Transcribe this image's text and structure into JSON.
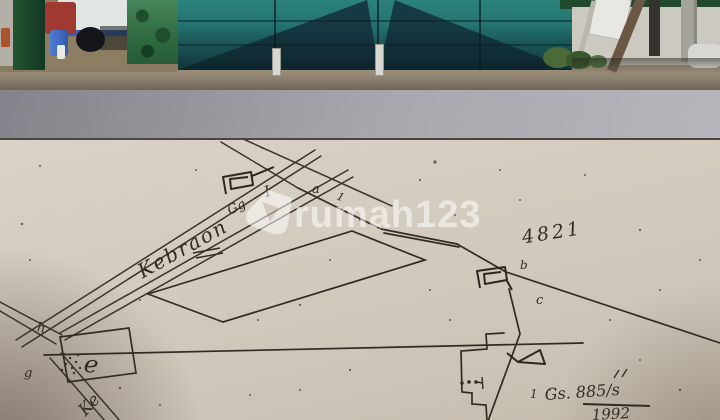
{
  "listing_watermark": {
    "brand": "rumah123"
  },
  "site_plan": {
    "street_label": "Kebraon",
    "alley_label": "Gg",
    "alley_number": "I",
    "street_label_south": "Ke",
    "parcel_number": "4821",
    "survey_ref": "Gs. 885/s",
    "survey_year": "1992",
    "points": {
      "a": "a",
      "b": "b",
      "c": "c",
      "e": "e",
      "g": "g",
      "h": "h"
    },
    "tick_after_a": "1",
    "ref_tick": "1"
  },
  "colors": {
    "paper": "#d2cabd",
    "ink": "#332b23",
    "gate_teal": "#22706c",
    "gate_dark": "#14313b",
    "gate_post_green": "#2f6a3e",
    "watermark": "#ffffff",
    "road_gray": "#a9a8ae",
    "truck_cab_red": "#a03a31",
    "barrel_blue": "#3f6cc8"
  }
}
